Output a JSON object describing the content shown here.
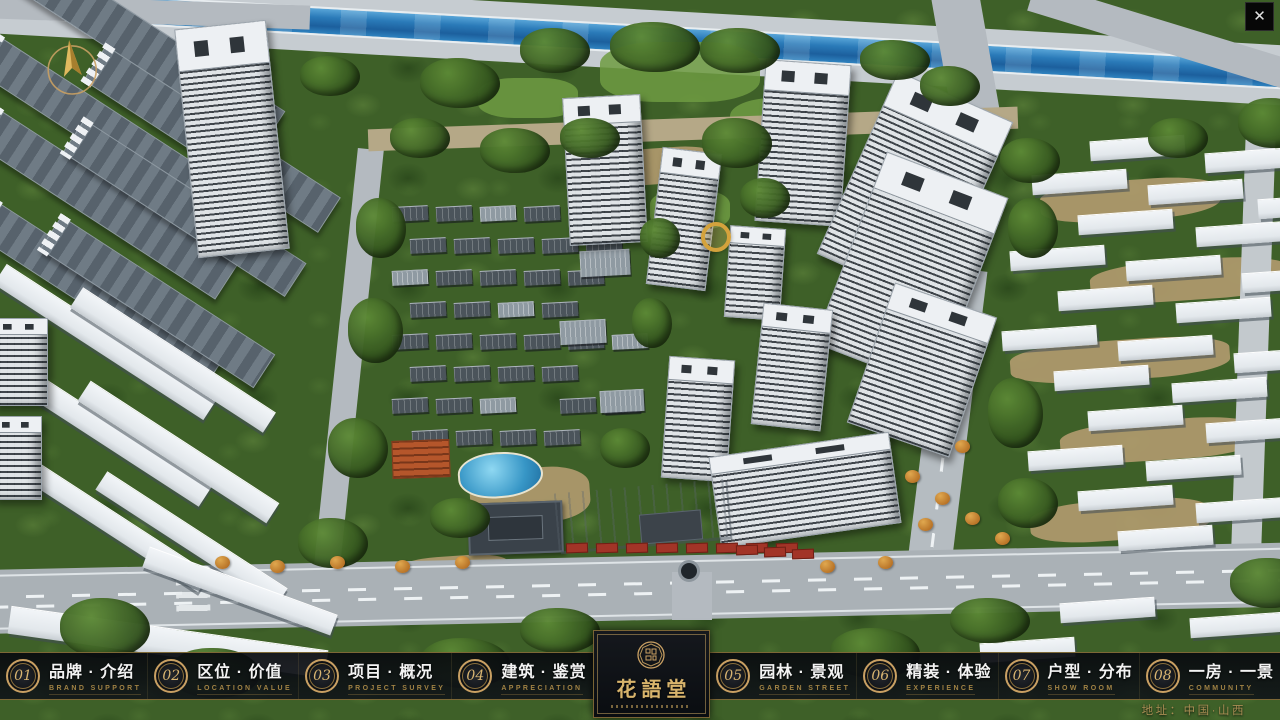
{
  "window": {
    "close_label": "✕"
  },
  "nav": {
    "items": [
      {
        "number": "01",
        "title": "品牌 · 介绍",
        "subtitle": "BRAND SUPPORT"
      },
      {
        "number": "02",
        "title": "区位 · 价值",
        "subtitle": "LOCATION VALUE"
      },
      {
        "number": "03",
        "title": "项目 · 概况",
        "subtitle": "PROJECT SURVEY"
      },
      {
        "number": "04",
        "title": "建筑 · 鉴赏",
        "subtitle": "APPRECIATION"
      },
      {
        "number": "05",
        "title": "园林 · 景观",
        "subtitle": "GARDEN STREET"
      },
      {
        "number": "06",
        "title": "精装 · 体验",
        "subtitle": "EXPERIENCE"
      },
      {
        "number": "07",
        "title": "户型 · 分布",
        "subtitle": "SHOW ROOM"
      },
      {
        "number": "08",
        "title": "一房 · 一景",
        "subtitle": "COMMUNITY"
      }
    ]
  },
  "logo": {
    "name": "花語堂"
  },
  "footer": {
    "address": "地址：中国·山西"
  },
  "icons": {
    "compass": "north-compass-arrow",
    "close": "close-x",
    "seal": "circular-brand-seal"
  },
  "colors": {
    "gold": "#c9a063",
    "bar_background": "#0b0e13",
    "title_text": "#f3f3f3",
    "subtitle_text": "#a08244",
    "address_text": "#a98e54",
    "river_blue": "#2a7ab8"
  }
}
